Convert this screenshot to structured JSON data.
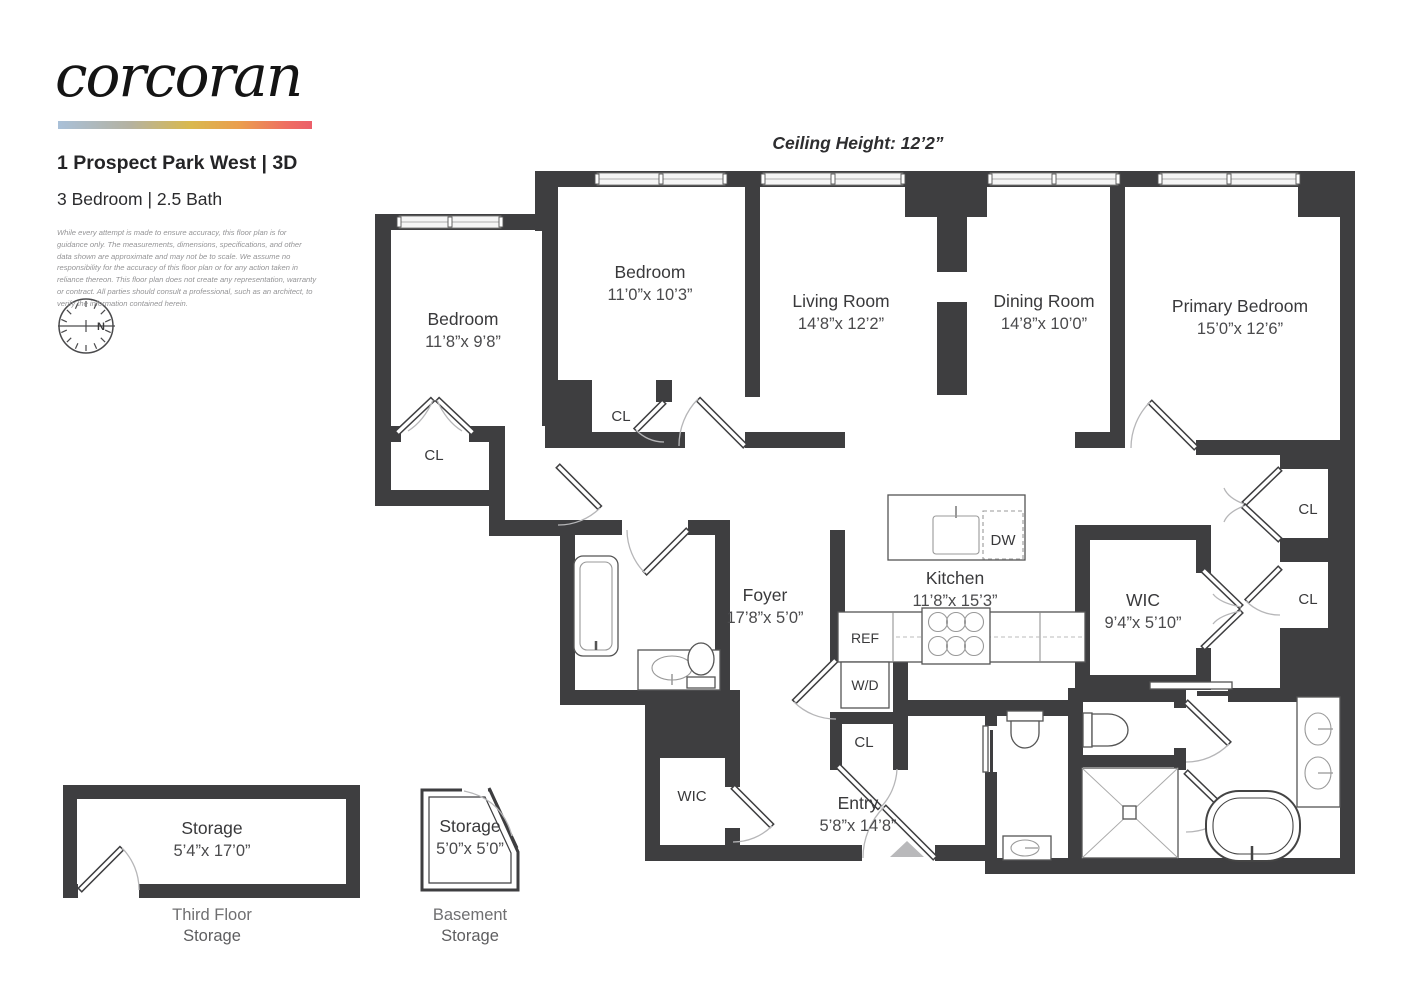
{
  "header": {
    "logo": "corcoran",
    "address": "1 Prospect Park West | 3D",
    "unit_info": "3 Bedroom | 2.5 Bath",
    "disclaimer": "While every attempt is made to ensure accuracy, this floor plan is for guidance only. The measurements, dimensions, specifications, and other data shown are approximate and may not be to scale. We assume no responsibility for the accuracy of this floor plan or for any action taken in reliance thereon. This floor plan does not create any representation, warranty or contract. All parties should consult a professional, such as an architect, to verify the information contained herein."
  },
  "floorplan": {
    "ceiling_height": "Ceiling Height: 12’2”",
    "compass_north": "N",
    "rooms": [
      {
        "name": "Bedroom",
        "dims": "11’8”x 9’8”"
      },
      {
        "name": "Bedroom",
        "dims": "11’0”x 10’3”"
      },
      {
        "name": "Living Room",
        "dims": "14’8”x 12’2”"
      },
      {
        "name": "Dining Room",
        "dims": "14’8”x 10’0”"
      },
      {
        "name": "Primary Bedroom",
        "dims": "15’0”x 12’6”"
      },
      {
        "name": "Foyer",
        "dims": "17’8”x 5’0”"
      },
      {
        "name": "Kitchen",
        "dims": "11’8”x 15’3”"
      },
      {
        "name": "WIC",
        "dims": "9’4”x 5’10”"
      },
      {
        "name": "Entry",
        "dims": "5’8”x 14’8”"
      }
    ],
    "small_labels": {
      "wic": "WIC",
      "washer_dryer": "W/D",
      "refrigerator": "REF",
      "dishwasher": "DW"
    },
    "closets": [
      "CL",
      "CL",
      "CL",
      "CL",
      "CL"
    ]
  },
  "storage_units": [
    {
      "name": "Storage",
      "dims": "5’4”x 17’0”",
      "floor": "Third Floor",
      "type": "Storage"
    },
    {
      "name": "Storage",
      "dims": "5’0”x 5’0”",
      "floor": "Basement",
      "type": "Storage"
    }
  ]
}
